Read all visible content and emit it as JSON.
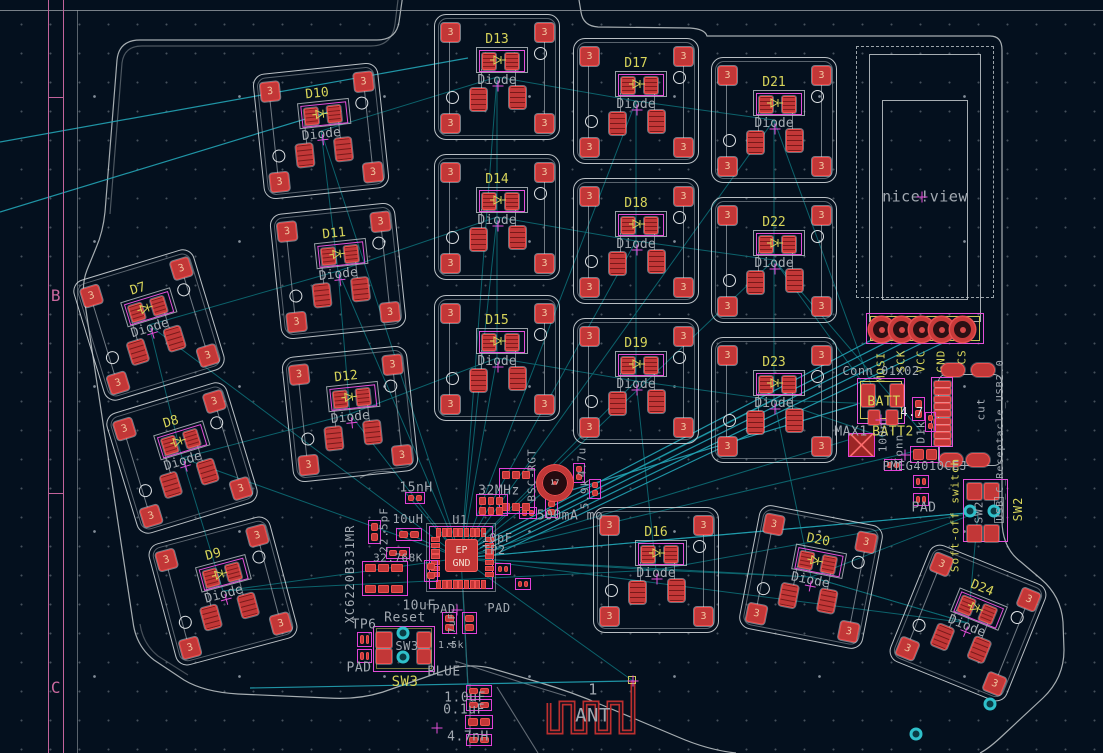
{
  "app": "pcb-editor-canvas",
  "frame": {
    "rows": [
      {
        "label": "B",
        "y": 296
      },
      {
        "label": "C",
        "y": 688
      }
    ]
  },
  "display": {
    "label": "nice!view"
  },
  "mcu": {
    "ref": "U1",
    "ep_line1": "EP",
    "ep_line2": "GND"
  },
  "key_template": {
    "corner_pad": "3",
    "diode_label": "Diode"
  },
  "keys": [
    {
      "ref": "D13",
      "x": 434,
      "y": 14,
      "rot": 0
    },
    {
      "ref": "D14",
      "x": 434,
      "y": 154,
      "rot": 0
    },
    {
      "ref": "D15",
      "x": 434,
      "y": 295,
      "rot": 0
    },
    {
      "ref": "D17",
      "x": 573,
      "y": 38,
      "rot": 0
    },
    {
      "ref": "D18",
      "x": 573,
      "y": 178,
      "rot": 0
    },
    {
      "ref": "D19",
      "x": 573,
      "y": 318,
      "rot": 0
    },
    {
      "ref": "D21",
      "x": 711,
      "y": 57,
      "rot": 0
    },
    {
      "ref": "D22",
      "x": 711,
      "y": 197,
      "rot": 0
    },
    {
      "ref": "D23",
      "x": 711,
      "y": 337,
      "rot": 0
    },
    {
      "ref": "D16",
      "x": 593,
      "y": 507,
      "rot": 0
    },
    {
      "ref": "D20",
      "x": 748,
      "y": 514,
      "rot": 11
    },
    {
      "ref": "D24",
      "x": 905,
      "y": 560,
      "rot": 22
    },
    {
      "ref": "D10",
      "x": 258,
      "y": 68,
      "rot": -6
    },
    {
      "ref": "D11",
      "x": 275,
      "y": 208,
      "rot": -6
    },
    {
      "ref": "D12",
      "x": 287,
      "y": 351,
      "rot": -6
    },
    {
      "ref": "D7",
      "x": 86,
      "y": 262,
      "rot": -17
    },
    {
      "ref": "D8",
      "x": 119,
      "y": 395,
      "rot": -17
    },
    {
      "ref": "D9",
      "x": 160,
      "y": 528,
      "rot": -15
    }
  ],
  "header": {
    "pins": [
      "MOSI",
      "SCK",
      "VCC",
      "GND",
      "CS"
    ],
    "pin_x": [
      881,
      901,
      921,
      941,
      962
    ],
    "label_y": [
      367,
      361,
      361,
      361,
      357
    ],
    "pad_y": 329
  },
  "labels": [
    {
      "t": "Conn_01x02",
      "x": 881,
      "y": 371,
      "c": "g",
      "s": 12
    },
    {
      "t": "BATT",
      "x": 884,
      "y": 402,
      "c": "y",
      "s": 13
    },
    {
      "t": "MAX1",
      "x": 851,
      "y": 432,
      "c": "g",
      "s": 13
    },
    {
      "t": "BATT2",
      "x": 893,
      "y": 432,
      "c": "y",
      "s": 13
    },
    {
      "t": "4.7",
      "x": 912,
      "y": 412,
      "c": "w",
      "s": 12
    },
    {
      "t": "100n",
      "x": 883,
      "y": 437,
      "c": "g",
      "s": 11,
      "v": true
    },
    {
      "t": "Conn",
      "x": 899,
      "y": 449,
      "c": "g",
      "s": 11,
      "v": true
    },
    {
      "t": "D1k",
      "x": 921,
      "y": 432,
      "c": "g",
      "s": 11,
      "v": true
    },
    {
      "t": "PMEG4010CEJ",
      "x": 925,
      "y": 466,
      "c": "g",
      "s": 12
    },
    {
      "t": "PAD",
      "x": 924,
      "y": 508,
      "c": "g",
      "s": 13
    },
    {
      "t": "cut",
      "x": 981,
      "y": 409,
      "c": "g",
      "s": 11,
      "v": true
    },
    {
      "t": "USB_C_Receptacle_USB2.0",
      "x": 1001,
      "y": 440,
      "c": "g",
      "s": 10,
      "v": true
    },
    {
      "t": "Soft-off switch",
      "x": 955,
      "y": 515,
      "c": "y",
      "s": 11,
      "v": true
    },
    {
      "t": "SW2",
      "x": 1018,
      "y": 509,
      "c": "y",
      "s": 12,
      "v": true
    },
    {
      "t": "SW2",
      "x": 979,
      "y": 512,
      "c": "g",
      "s": 11,
      "v": true
    },
    {
      "t": "15nH",
      "x": 416,
      "y": 488,
      "c": "g",
      "s": 13
    },
    {
      "t": "10uH",
      "x": 408,
      "y": 519,
      "c": "g",
      "s": 12
    },
    {
      "t": "32MHz",
      "x": 499,
      "y": 491,
      "c": "g",
      "s": 13
    },
    {
      "t": "U1",
      "x": 460,
      "y": 520,
      "c": "g",
      "s": 12
    },
    {
      "t": "22.5pF",
      "x": 384,
      "y": 530,
      "c": "g",
      "s": 11,
      "v": true
    },
    {
      "t": "32.768K",
      "x": 398,
      "y": 558,
      "c": "g",
      "s": 11
    },
    {
      "t": "XC6220B331MR",
      "x": 350,
      "y": 574,
      "c": "g",
      "s": 12,
      "v": true
    },
    {
      "t": "10pF",
      "x": 497,
      "y": 538,
      "c": "g",
      "s": 12
    },
    {
      "t": "TP2",
      "x": 494,
      "y": 550,
      "c": "g",
      "s": 12
    },
    {
      "t": "17",
      "x": 555,
      "y": 483,
      "c": "w",
      "s": 7
    },
    {
      "t": "BSC-RGT",
      "x": 532,
      "y": 475,
      "c": "g",
      "s": 11,
      "v": true
    },
    {
      "t": "4.7u",
      "x": 582,
      "y": 462,
      "c": "g",
      "s": 11,
      "v": true
    },
    {
      "t": "5.9k",
      "x": 585,
      "y": 494,
      "c": "g",
      "s": 11,
      "v": true
    },
    {
      "t": "500mA mo",
      "x": 570,
      "y": 516,
      "c": "g",
      "s": 13
    },
    {
      "t": "10uF",
      "x": 419,
      "y": 606,
      "c": "g",
      "s": 13
    },
    {
      "t": "PAD",
      "x": 444,
      "y": 609,
      "c": "g",
      "s": 12
    },
    {
      "t": "PAD",
      "x": 499,
      "y": 608,
      "c": "g",
      "s": 12
    },
    {
      "t": "Reset",
      "x": 405,
      "y": 618,
      "c": "g",
      "s": 13
    },
    {
      "t": "TP6",
      "x": 364,
      "y": 625,
      "c": "g",
      "s": 13
    },
    {
      "t": "PAD",
      "x": 359,
      "y": 668,
      "c": "g",
      "s": 13
    },
    {
      "t": "SW3",
      "x": 407,
      "y": 646,
      "c": "g",
      "s": 12
    },
    {
      "t": "SW3",
      "x": 405,
      "y": 682,
      "c": "y",
      "s": 14
    },
    {
      "t": "BLUE",
      "x": 444,
      "y": 672,
      "c": "g",
      "s": 13
    },
    {
      "t": "1.5k",
      "x": 451,
      "y": 646,
      "c": "g",
      "s": 10
    },
    {
      "t": "4.7uF",
      "x": 453,
      "y": 630,
      "c": "g",
      "s": 10,
      "v": true
    },
    {
      "t": "1.0uF",
      "x": 465,
      "y": 698,
      "c": "g",
      "s": 13
    },
    {
      "t": "0.1uF",
      "x": 464,
      "y": 710,
      "c": "g",
      "s": 13
    },
    {
      "t": "4.7nH",
      "x": 468,
      "y": 737,
      "c": "g",
      "s": 13
    },
    {
      "t": "1",
      "x": 593,
      "y": 690,
      "c": "g",
      "s": 15
    },
    {
      "t": "ANT",
      "x": 593,
      "y": 716,
      "c": "g",
      "s": 19
    }
  ],
  "components": {
    "passives": [
      [
        405,
        492,
        20,
        12,
        "h"
      ],
      [
        396,
        528,
        26,
        13,
        "h"
      ],
      [
        368,
        520,
        13,
        24,
        "v"
      ],
      [
        386,
        547,
        24,
        12,
        "h"
      ],
      [
        424,
        560,
        14,
        22,
        "v"
      ],
      [
        442,
        612,
        15,
        22,
        "v"
      ],
      [
        462,
        612,
        15,
        22,
        "v"
      ],
      [
        519,
        507,
        18,
        12,
        "h"
      ],
      [
        545,
        498,
        13,
        20,
        "v"
      ],
      [
        573,
        463,
        12,
        20,
        "v"
      ],
      [
        589,
        479,
        12,
        20,
        "v"
      ],
      [
        466,
        685,
        26,
        12,
        "h"
      ],
      [
        466,
        699,
        26,
        12,
        "h"
      ],
      [
        465,
        715,
        28,
        14,
        "h"
      ],
      [
        466,
        734,
        26,
        12,
        "h"
      ],
      [
        357,
        632,
        15,
        15,
        "h"
      ],
      [
        357,
        649,
        15,
        14,
        "h"
      ],
      [
        912,
        397,
        13,
        24,
        "v"
      ],
      [
        925,
        412,
        11,
        20,
        "v"
      ],
      [
        910,
        446,
        30,
        17,
        "h"
      ],
      [
        913,
        475,
        16,
        13,
        "h"
      ],
      [
        913,
        493,
        16,
        13,
        "h"
      ],
      [
        884,
        459,
        18,
        12,
        "h"
      ],
      [
        495,
        563,
        16,
        12,
        "h"
      ],
      [
        515,
        578,
        16,
        12,
        "h"
      ]
    ],
    "ics": [
      [
        362,
        561,
        46,
        35
      ],
      [
        499,
        468,
        36,
        46
      ],
      [
        476,
        494,
        32,
        22
      ]
    ],
    "ic_x": [
      [
        848,
        433,
        27,
        24
      ]
    ],
    "rings": [
      [
        555,
        483,
        26
      ]
    ],
    "cyan_pads": [
      [
        403,
        633
      ],
      [
        403,
        657
      ],
      [
        970,
        511
      ],
      [
        994,
        511
      ],
      [
        916,
        734
      ],
      [
        990,
        704
      ]
    ],
    "crosses": [
      [
        633,
        681
      ],
      [
        881,
        420
      ],
      [
        922,
        197
      ],
      [
        437,
        728
      ],
      [
        457,
        610
      ],
      [
        905,
        455
      ]
    ]
  }
}
